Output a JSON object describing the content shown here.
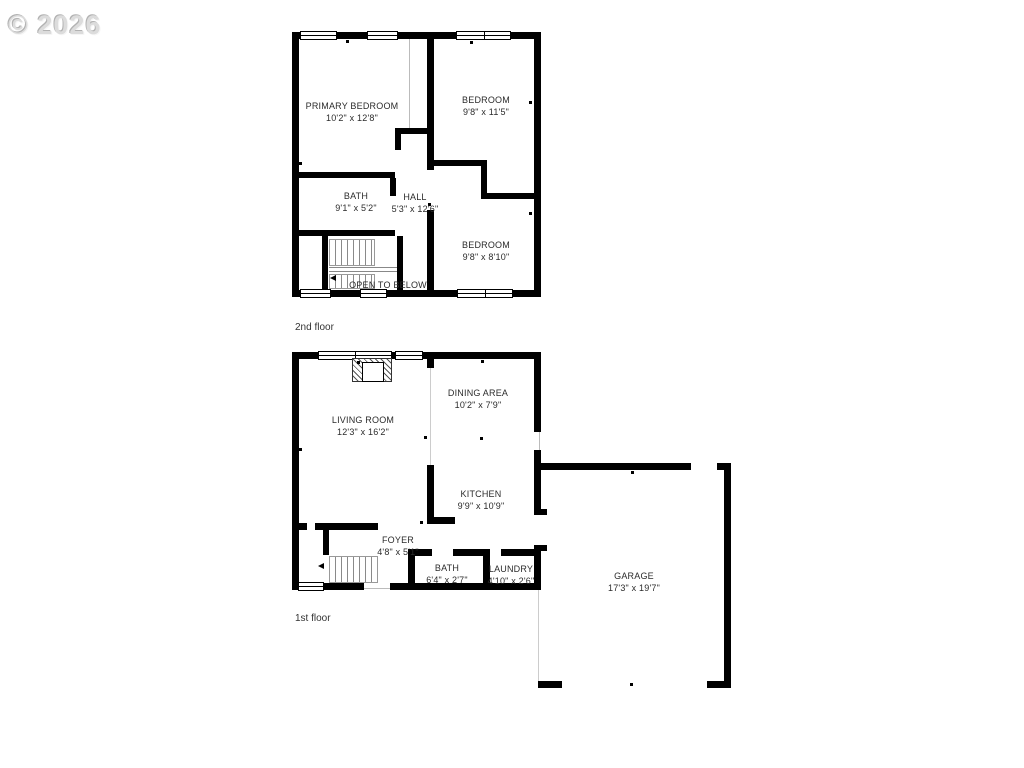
{
  "watermark": "© 2026",
  "second_floor": {
    "label": "2nd floor",
    "open_to_below": "OPEN TO BELOW",
    "rooms": {
      "primary_bedroom": {
        "name": "PRIMARY BEDROOM",
        "dims": "10'2\" x 12'8\""
      },
      "bedroom_top": {
        "name": "BEDROOM",
        "dims": "9'8\" x 11'5\""
      },
      "bath": {
        "name": "BATH",
        "dims": "9'1\" x 5'2\""
      },
      "hall": {
        "name": "HALL",
        "dims": "5'3\" x 12'6\""
      },
      "bedroom_bottom": {
        "name": "BEDROOM",
        "dims": "9'8\" x 8'10\""
      }
    }
  },
  "first_floor": {
    "label": "1st floor",
    "rooms": {
      "living_room": {
        "name": "LIVING ROOM",
        "dims": "12'3\" x 16'2\""
      },
      "dining_area": {
        "name": "DINING AREA",
        "dims": "10'2\" x 7'9\""
      },
      "kitchen": {
        "name": "KITCHEN",
        "dims": "9'9\" x 10'9\""
      },
      "foyer": {
        "name": "FOYER",
        "dims": "4'8\" x 5'1\""
      },
      "bath": {
        "name": "BATH",
        "dims": "6'4\" x 2'7\""
      },
      "laundry": {
        "name": "LAUNDRY",
        "dims": "4'10\" x 2'6\""
      },
      "garage": {
        "name": "GARAGE",
        "dims": "17'3\" x 19'7\""
      }
    }
  }
}
